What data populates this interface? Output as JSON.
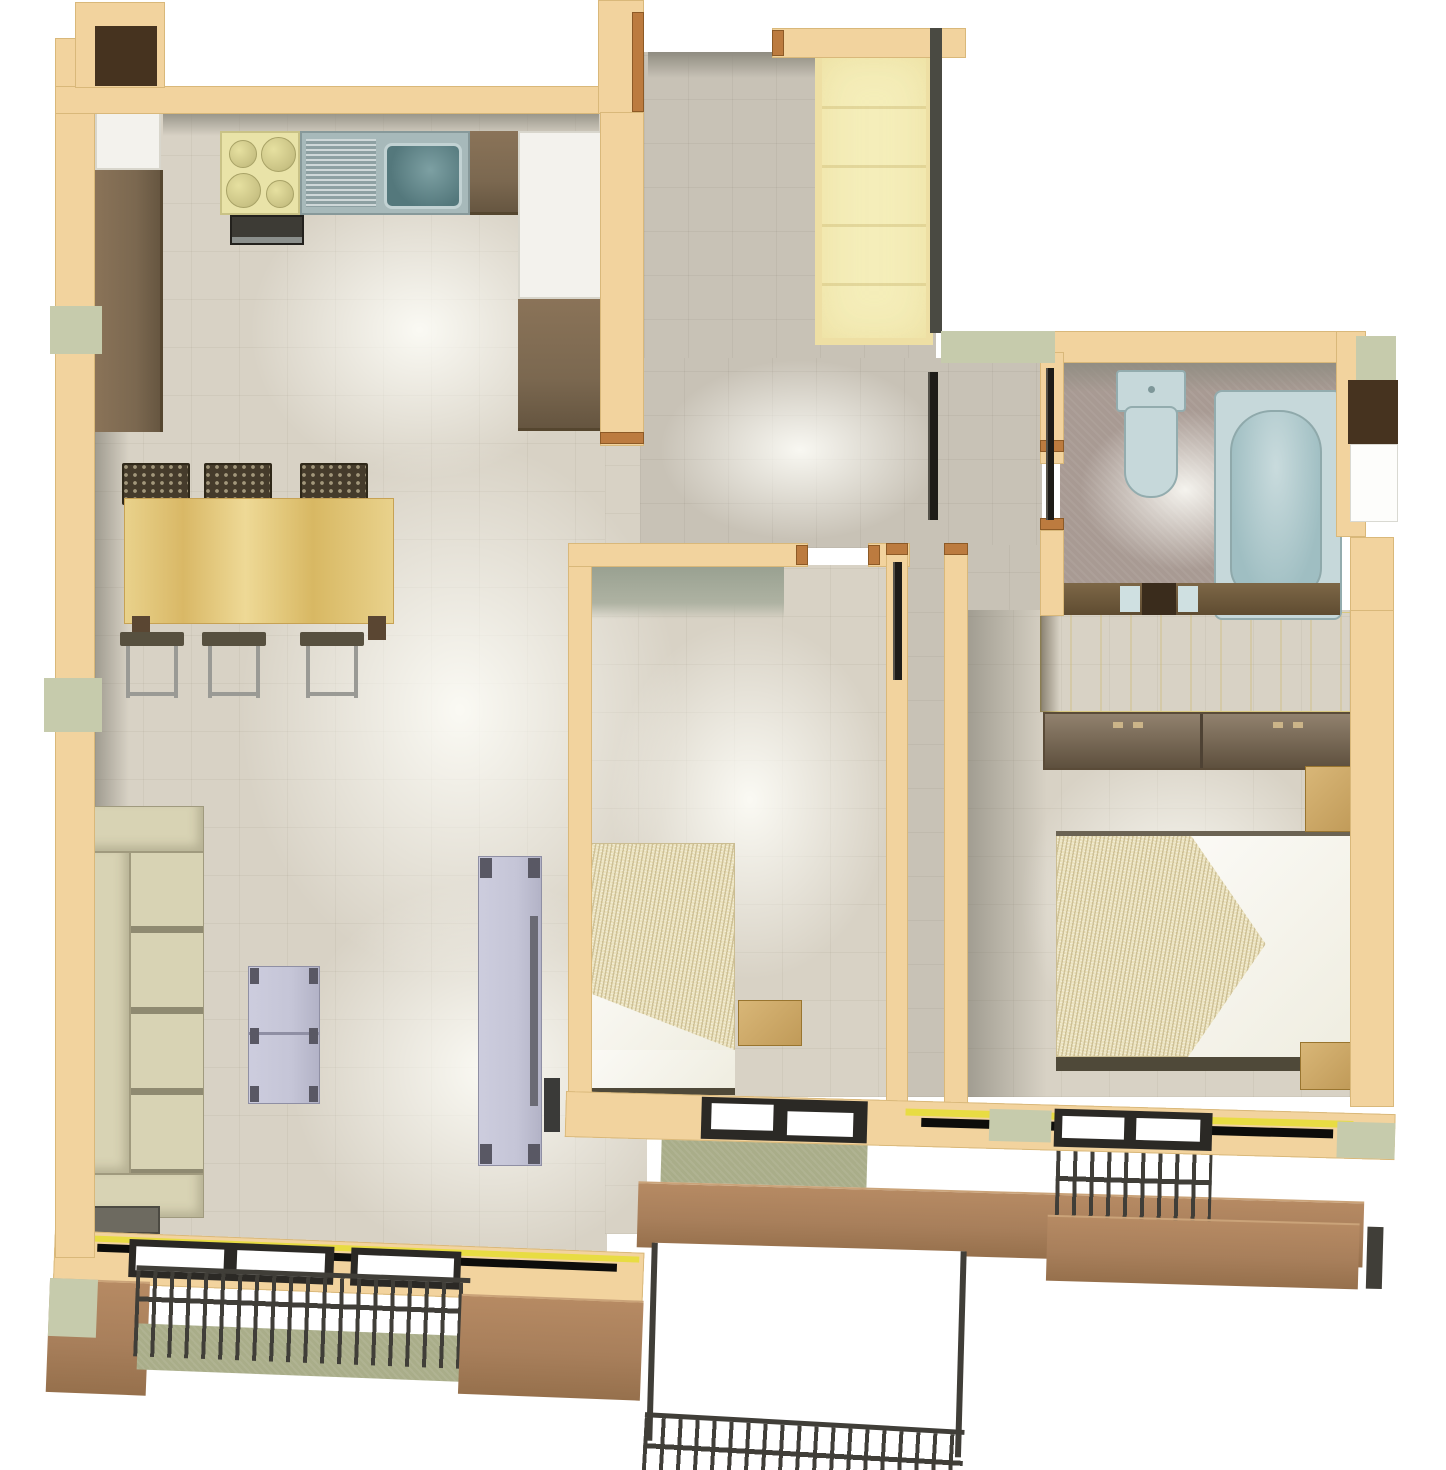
{
  "meta": {
    "kind": "3d-floor-plan-render",
    "view": "top-down",
    "text_visible": false
  },
  "palette": {
    "wall": "#f2d39e",
    "wallEdge": "#d9b87a",
    "dark": "#4a4a42",
    "floor": "#d8d2c5",
    "floorDim": "#c8c2b6",
    "bath": "#a89a93",
    "face": "#8f8c81",
    "faceGreen": "#98a090",
    "counter": "#7b6850",
    "cabinetWhite": "#f3f2ed",
    "stove": "#e9e3a8",
    "steel": "#a7b9ba",
    "steelDark": "#54787c",
    "wood": "#e0c277",
    "woodLight": "#d9b778",
    "chair": "#453b2b",
    "sofa": "#d8d3b4",
    "sofaShadow": "#8f8a71",
    "lavender": "#c5c5d7",
    "lavenderDark": "#595864",
    "blanket": "#ebe2bd",
    "pillow": "#efede0",
    "wardrobePale": "#f5eeba",
    "wardrobeYellow": "#f3ea9e",
    "sage": "#c6cbac",
    "olive": "#a9ad89",
    "parapet": "#a87f5b",
    "railing": "#403e38",
    "frame": "#2b2925",
    "glass": "#ffffff",
    "jamb": "#bc7b3f",
    "tub": "#c6d8da",
    "tubDeep": "#9fbec2",
    "fixtureEdge": "#93acae",
    "yellowLine": "#e8dc43",
    "brownBlock": "#46331f"
  },
  "rooms": [
    {
      "name": "kitchen-living",
      "furniture": [
        "stove-4-burners",
        "sink-with-drainboard",
        "brown-counters",
        "white-cabinets",
        "oven",
        "dining-table",
        "three-chairs",
        "three-stools",
        "sofa",
        "side-table",
        "coffee-table",
        "tv-unit"
      ]
    },
    {
      "name": "entry-hall",
      "furniture": [
        "pale-yellow-wardrobe"
      ]
    },
    {
      "name": "bathroom",
      "furniture": [
        "toilet",
        "bathtub",
        "vanity-with-sink"
      ]
    },
    {
      "name": "bedroom-small",
      "furniture": [
        "single-bed",
        "nightstand"
      ]
    },
    {
      "name": "bedroom-large",
      "furniture": [
        "double-bed",
        "two-pillows",
        "yellow-wardrobe",
        "brown-cabinets",
        "nightstand-top",
        "nightstand-bottom"
      ]
    },
    {
      "name": "balcony-left",
      "furniture": [
        "metal-railing",
        "parapet"
      ]
    },
    {
      "name": "balcony-center",
      "furniture": [
        "metal-railing",
        "parapet",
        "lower-terrace"
      ]
    },
    {
      "name": "balcony-right",
      "furniture": [
        "metal-railing",
        "parapet"
      ]
    }
  ]
}
